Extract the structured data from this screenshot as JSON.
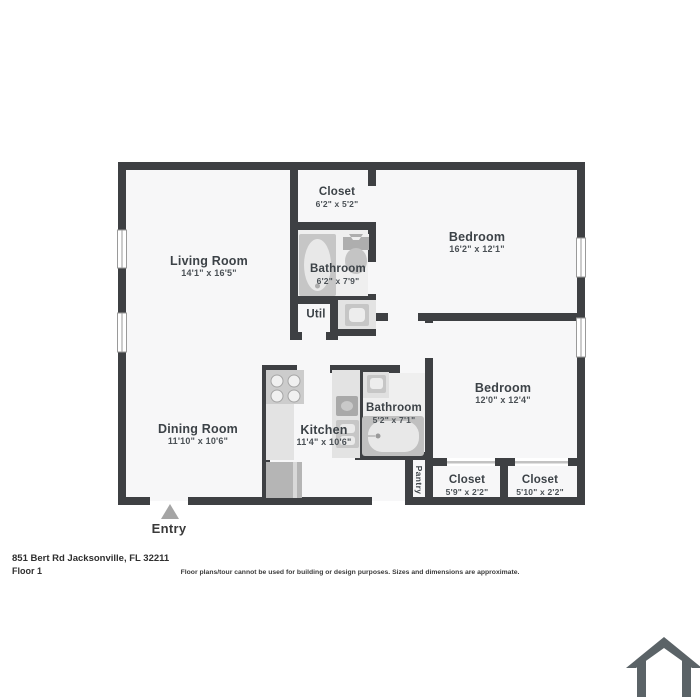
{
  "plan": {
    "wall_color": "#3e4043",
    "floor_color": "#f7f7f8",
    "bath_floor_color": "#efefef",
    "counter_color": "#e3e3e3",
    "fixture_color": "#c6c6c6",
    "fixture_inner_color": "#e8e8e8",
    "window_line_color": "#9a9a9a",
    "closet_door_line_color": "#c2c2c2"
  },
  "rooms": {
    "living_room": {
      "name": "Living Room",
      "dims": "14'1\" x 16'5\""
    },
    "closet_top": {
      "name": "Closet",
      "dims": "6'2\" x 5'2\""
    },
    "bedroom_1": {
      "name": "Bedroom",
      "dims": "16'2\" x 12'1\""
    },
    "bathroom_1": {
      "name": "Bathroom",
      "dims": "6'2\" x 7'9\""
    },
    "util": {
      "name": "Util"
    },
    "bedroom_2": {
      "name": "Bedroom",
      "dims": "12'0\" x 12'4\""
    },
    "kitchen": {
      "name": "Kitchen",
      "dims": "11'4\" x 10'6\""
    },
    "bathroom_2": {
      "name": "Bathroom",
      "dims": "5'2\" x 7'1\""
    },
    "dining_room": {
      "name": "Dining Room",
      "dims": "11'10\" x 10'6\""
    },
    "pantry": {
      "name": "Pantry"
    },
    "closet_left": {
      "name": "Closet",
      "dims": "5'9\" x 2'2\""
    },
    "closet_right": {
      "name": "Closet",
      "dims": "5'10\" x 2'2\""
    },
    "entry": {
      "name": "Entry"
    }
  },
  "footer": {
    "address": "851 Bert Rd Jacksonville, FL 32211",
    "floor": "Floor 1",
    "disclaimer": "Floor plans/tour cannot be used for building or design purposes. Sizes and dimensions are approximate."
  },
  "icons": {
    "house_icon": "house-outline",
    "house_icon_color": "#5b6367",
    "entry_arrow_color": "#a5a5a5"
  }
}
